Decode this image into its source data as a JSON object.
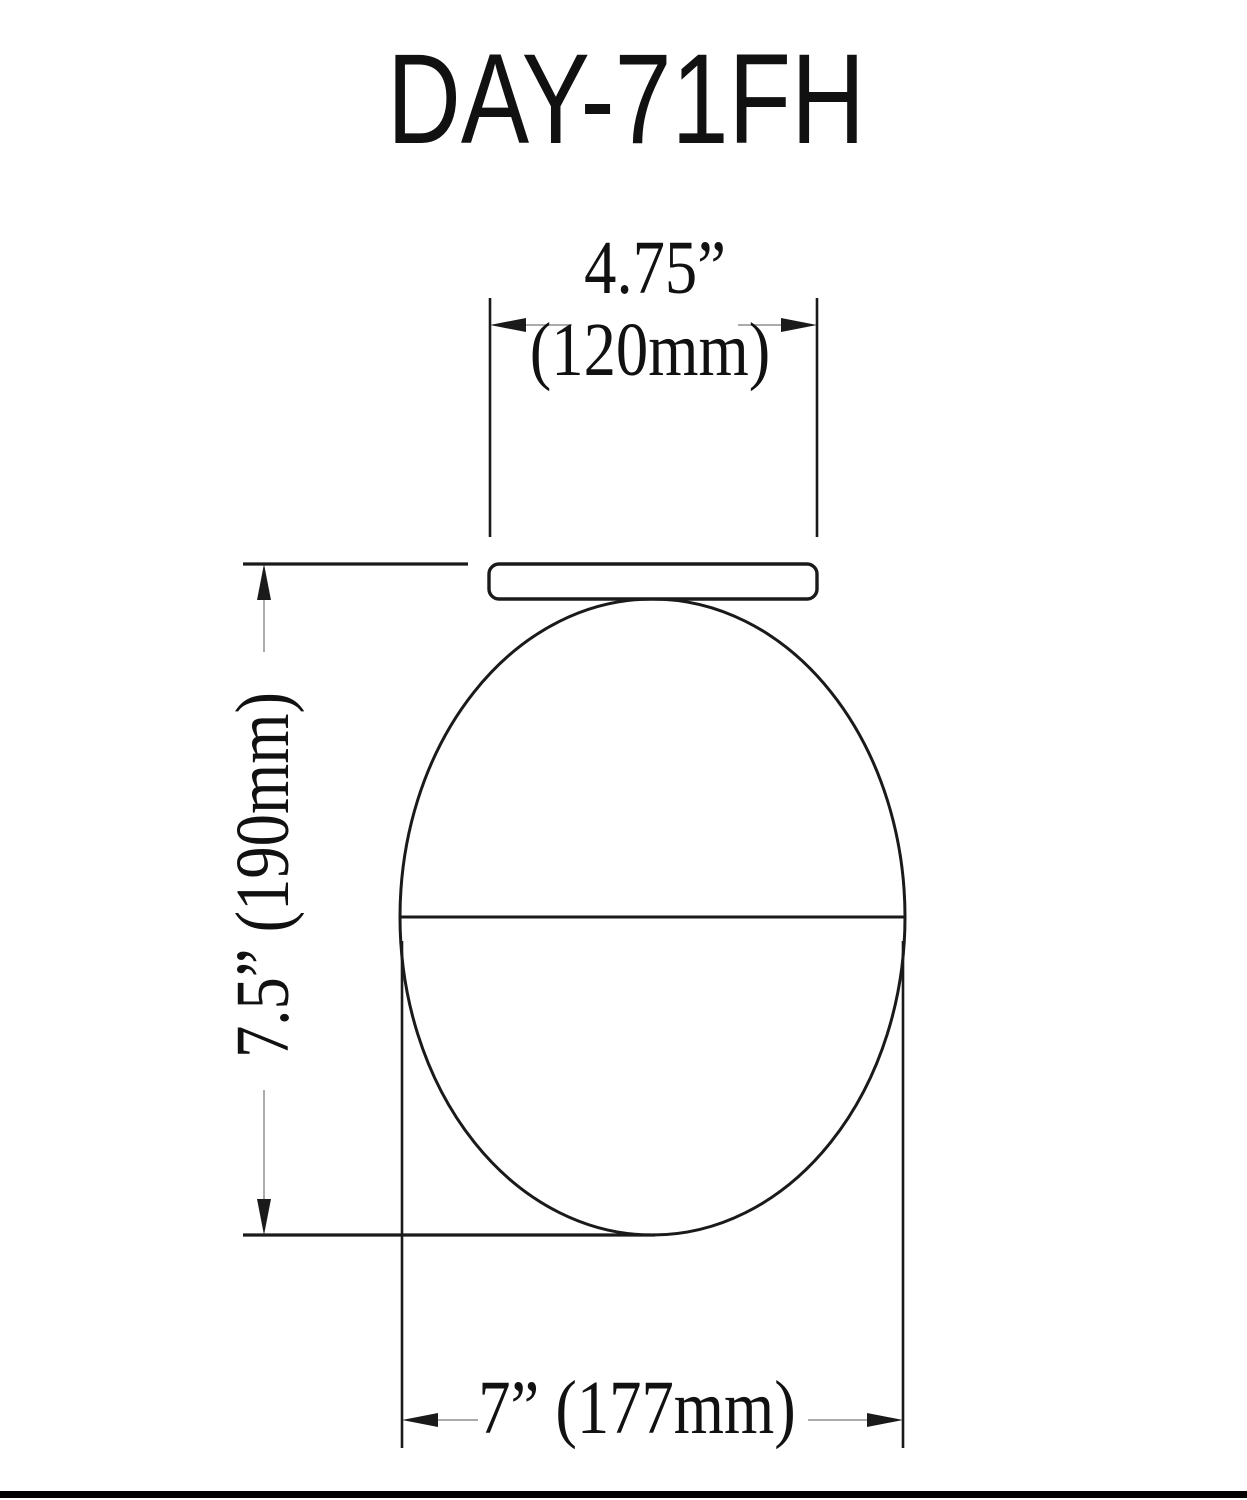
{
  "drawing": {
    "title": "DAY-71FH",
    "dimensions": {
      "top_width": {
        "imperial": "4.75”",
        "metric": "(120mm)"
      },
      "left_height": {
        "label": "7.5” (190mm)"
      },
      "bottom_width": {
        "label": "7” (177mm)"
      }
    },
    "colors": {
      "object_line": "#1a1a1a",
      "thin_leader_line": "#8f8f8f",
      "footer_bar": "#000000",
      "background": "#ffffff"
    }
  }
}
